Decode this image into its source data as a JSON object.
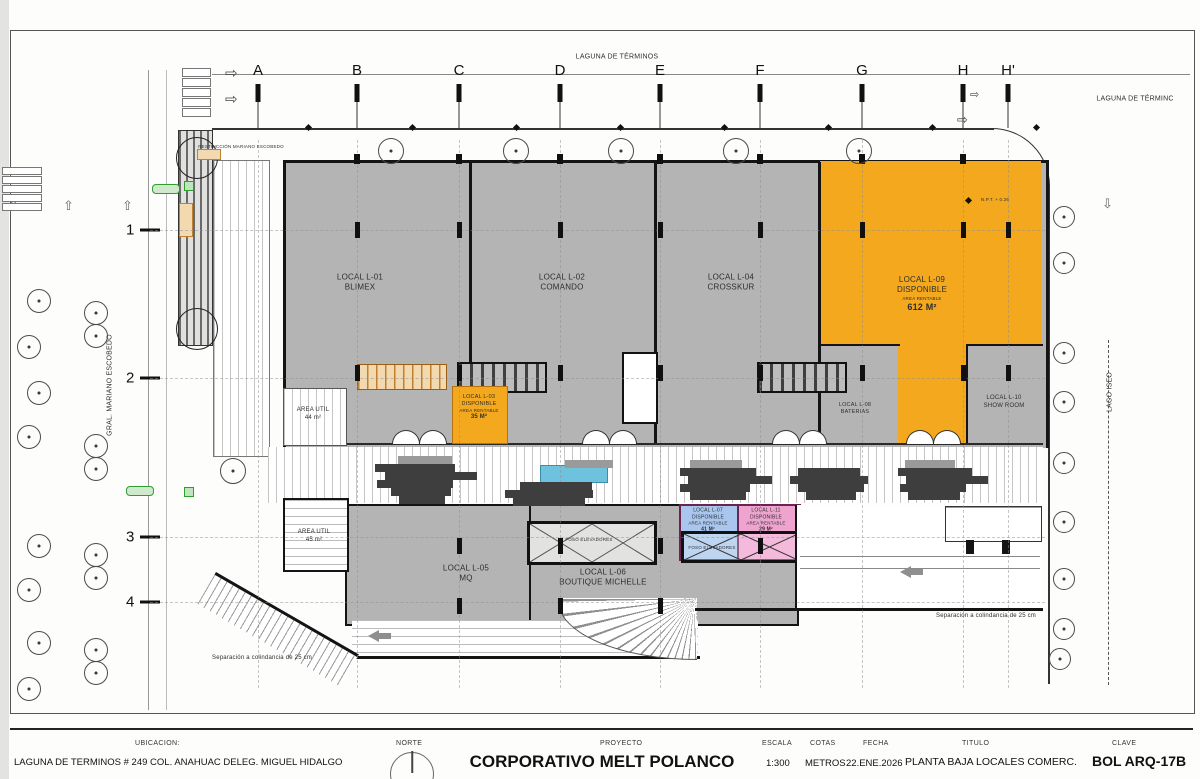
{
  "colors": {
    "local_gray": "#b4b4b4",
    "available_orange": "#f3a81e",
    "local_blue": "#a9c7ee",
    "local_pink": "#efa3cf",
    "water_blue": "#6fc2de",
    "paver_dark": "#3e3e3e",
    "wall_black": "#141414",
    "accent_green": "#2f9e2f"
  },
  "streets": {
    "top": "LAGUNA DE TÉRMINOS",
    "top_right": "LAGUNA DE TÉRMINC",
    "left": "GRAL. MARIANO ESCOBEDO",
    "right": "LAGO ISEO"
  },
  "grid": {
    "columns": [
      "A",
      "B",
      "C",
      "D",
      "E",
      "F",
      "G",
      "H",
      "H'"
    ],
    "rows": [
      "1",
      "2",
      "3",
      "4"
    ]
  },
  "annotations": {
    "restriction": "RESTRICCIÓN MARIANO ESCOBEDO",
    "separation_left": "Separación a colindancia de 25 cm",
    "separation_right": "Separación a colindancia de 25 cm",
    "npt": "N.P.T. + 0.26",
    "foso_1": "FOSO ELEVADORES",
    "foso_2": "FOSO ELEVADORES"
  },
  "locals": {
    "l01": {
      "id": "LOCAL L-01",
      "name": "BLIMEX"
    },
    "l02": {
      "id": "LOCAL L-02",
      "name": "COMANDO"
    },
    "l03": {
      "id": "LOCAL L-03",
      "name": "DISPONIBLE",
      "area_label": "AREA RENTABLE",
      "area": "35 M²"
    },
    "l04": {
      "id": "LOCAL L-04",
      "name": "CROSSKUR"
    },
    "l05": {
      "id": "LOCAL L-05",
      "name": "MQ"
    },
    "l06": {
      "id": "LOCAL L-06",
      "name": "BOUTIQUE MICHELLE"
    },
    "l07": {
      "id": "LOCAL L-07",
      "name": "DISPONIBLE",
      "area_label": "AREA RENTABLE",
      "area": "41 M²"
    },
    "l08": {
      "id": "LOCAL L-08",
      "name": "BATERIAS"
    },
    "l09": {
      "id": "LOCAL L-09",
      "name": "DISPONIBLE",
      "area_label": "AREA RENTABLE",
      "area": "612 M²"
    },
    "l10": {
      "id": "LOCAL L-10",
      "name": "SHOW ROOM"
    },
    "l11": {
      "id": "LOCAL L-11",
      "name": "DISPONIBLE",
      "area_label": "AREA RENTABLE",
      "area": "29 M²"
    },
    "area_util_a": {
      "id": "AREA UTIL",
      "area": "44 m²"
    },
    "area_util_b": {
      "id": "AREA UTIL",
      "area": "45 m²"
    }
  },
  "titleblock": {
    "ubicacion_label": "UBICACION:",
    "ubicacion_value": "LAGUNA DE TERMINOS # 249 COL. ANAHUAC DELEG. MIGUEL HIDALGO",
    "norte_label": "NORTE",
    "proyecto_label": "PROYECTO",
    "proyecto_value": "CORPORATIVO MELT POLANCO",
    "escala_label": "ESCALA",
    "escala_value": "1:300",
    "cotas_label": "COTAS",
    "cotas_value": "METROS",
    "fecha_label": "FECHA",
    "fecha_value": "22.ENE.2026",
    "titulo_label": "TITULO",
    "titulo_value": "PLANTA BAJA LOCALES COMERC.",
    "clave_label": "CLAVE",
    "clave_value": "BOL ARQ-17B"
  }
}
